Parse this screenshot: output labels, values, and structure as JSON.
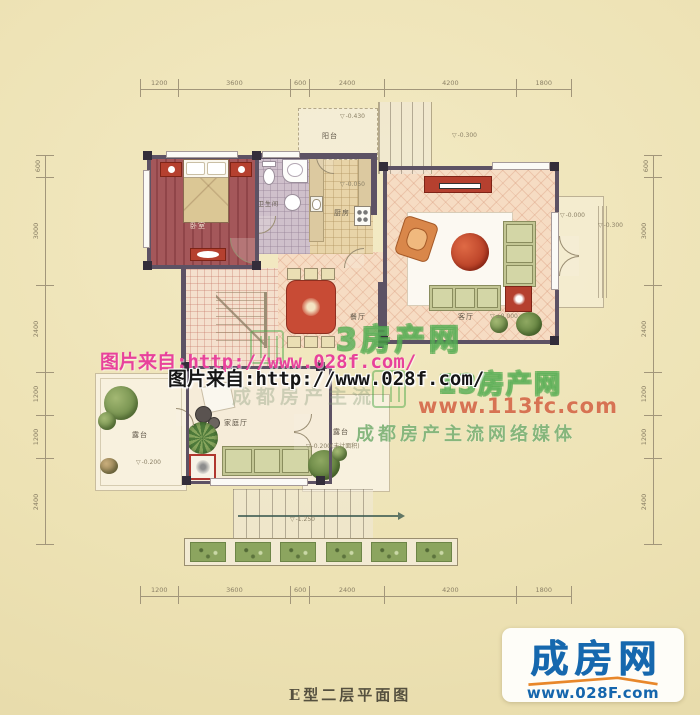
{
  "page": {
    "caption": "E型二层平面图"
  },
  "plan": {
    "rooms": {
      "bedroom": "卧室",
      "bathroom": "卫生间",
      "kitchen": "厨房",
      "balcony": "阳台",
      "dining": "餐厅",
      "living": "客厅",
      "family": "家庭厅",
      "terrace_left": "露台",
      "terrace_right": "露台"
    },
    "elevations": {
      "balcony": "-0.430",
      "stair_top": "-0.300",
      "kitchen": "-0.050",
      "entry_outer": "-0.000",
      "entry_step": "-0.300",
      "living": "±0.000",
      "terrace_left": "-0.200",
      "terrace_right": "-0.200(未计面积)",
      "stair_bottom": "-1.250"
    },
    "dimensions": {
      "top": [
        "1200",
        "3600",
        "600",
        "2400",
        "4200",
        "1800"
      ],
      "bottom": [
        "1200",
        "3600",
        "600",
        "2400",
        "4200",
        "1800"
      ],
      "left": [
        "600",
        "3000",
        "2400",
        "1200",
        "1200",
        "2400"
      ],
      "right": [
        "600",
        "3000",
        "2400",
        "1200",
        "1200",
        "2400"
      ]
    }
  },
  "watermarks": {
    "photo_source_magenta": "图片来自:http://www.028f.com/",
    "photo_source_black": "图片来自:http://www.028f.com/",
    "brand_text_upper": "3房产网",
    "brand_text_lower": "13房产网",
    "brand_url": "www.113fc.com",
    "brand_slogan": "成都房产主流网络媒体",
    "brand_slogan_faint": "成都房产主流"
  },
  "logo": {
    "brand": "成房网",
    "url": "www.028F.com"
  },
  "icons": {
    "level_marker": "▽"
  },
  "colors": {
    "background": "#ede2b4",
    "wall": "#5d5264",
    "bedroom_floor": "#a4575a",
    "tile_peach": "#f6dcc3",
    "accent_red": "#b5402f",
    "sofa_green": "#c3c694",
    "watermark_green": "#4faa4c",
    "watermark_magenta": "#e8429b",
    "watermark_red": "#cd502d",
    "brand_blue": "#1668ae",
    "brand_orange": "#e8872a"
  }
}
